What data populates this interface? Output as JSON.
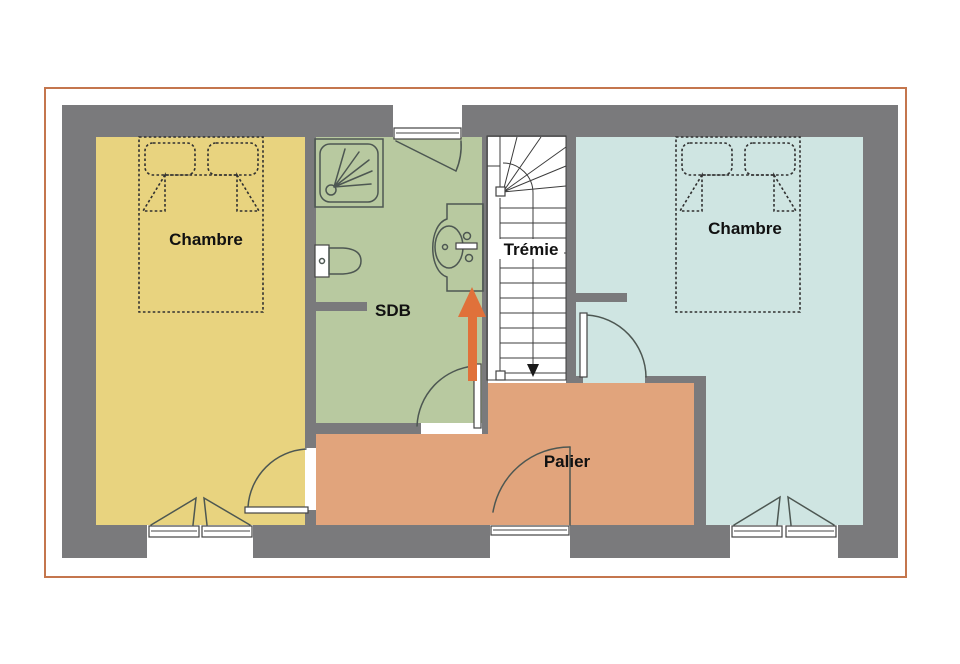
{
  "plan": {
    "type": "floor-plan",
    "rooms": {
      "bedroom_left": {
        "label": "Chambre",
        "color": "#e8d37f"
      },
      "bathroom": {
        "label": "SDB",
        "color": "#b8c9a0"
      },
      "stairwell": {
        "label": "Trémie",
        "color": "#ffffff"
      },
      "bedroom_right": {
        "label": "Chambre",
        "color": "#cfe5e2"
      },
      "landing": {
        "label": "Palier",
        "color": "#e1a47c"
      }
    },
    "fixtures": [
      "double-bed",
      "double-bed",
      "shower",
      "toilet",
      "sink",
      "staircase"
    ],
    "colors": {
      "wall": "#7a7a7c",
      "page_border": "#c4764d",
      "arrow": "#e0713a",
      "symbol_line": "#4d5752",
      "stair_line": "#3c3c3c",
      "bed_dash": "#303030",
      "frame_stroke": "#444444",
      "label_text": "#111111"
    }
  }
}
